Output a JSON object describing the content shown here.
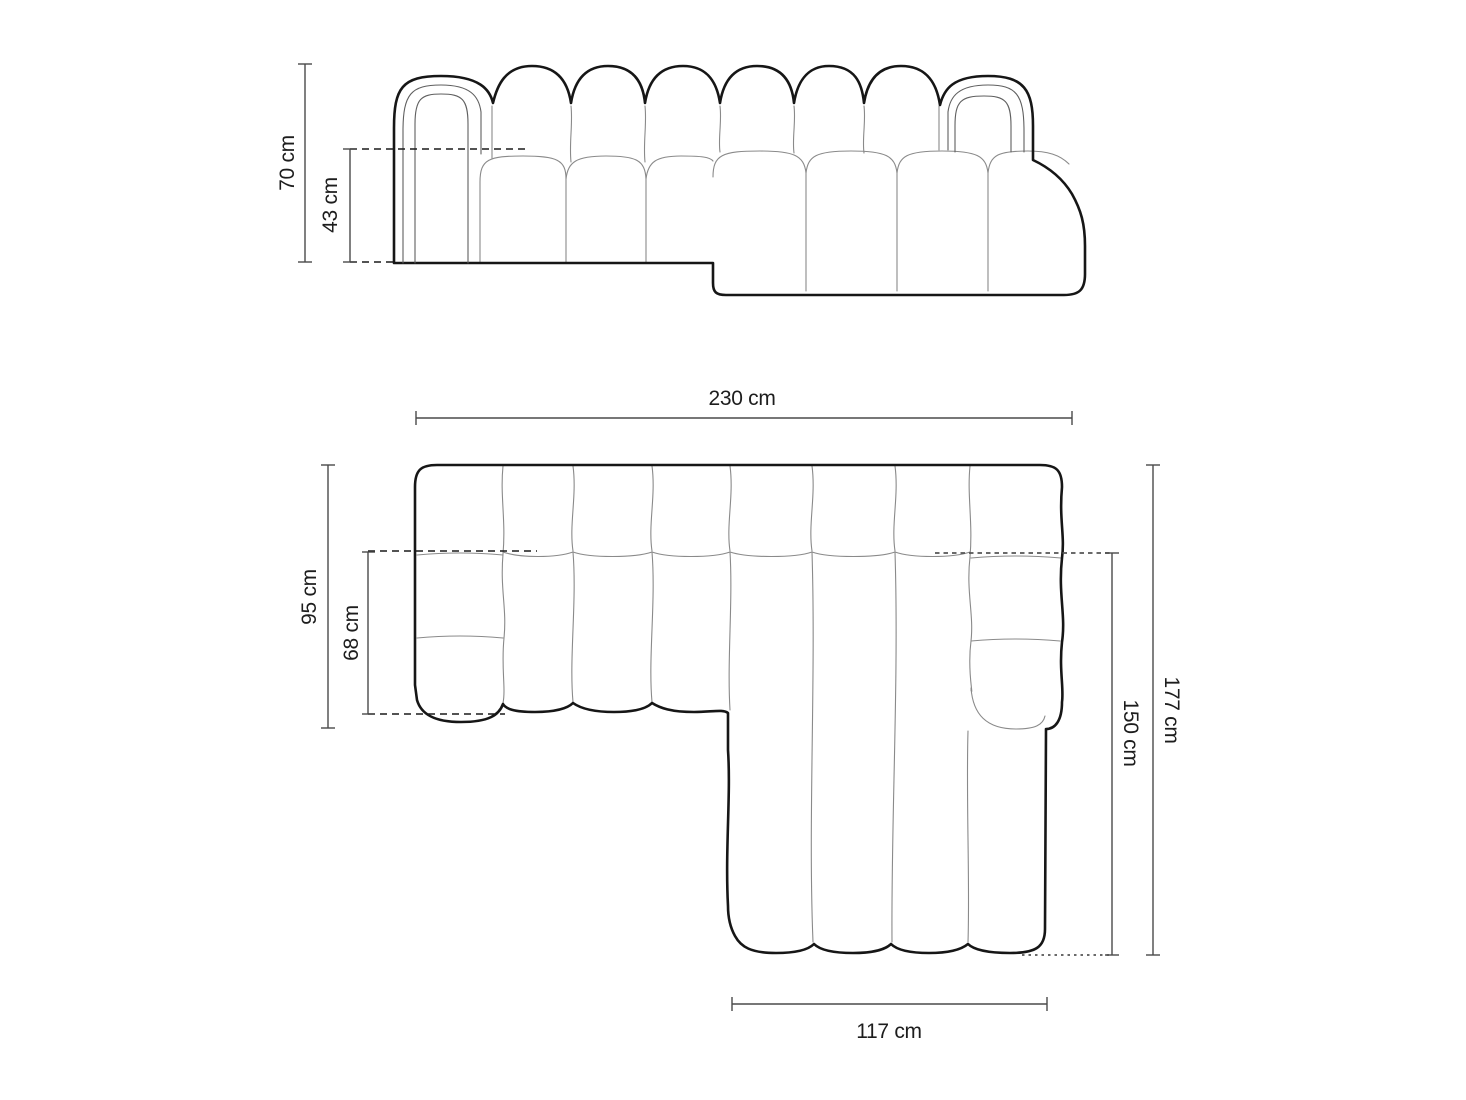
{
  "diagram": {
    "type": "furniture-dimension-diagram",
    "subject": "modular chaise sofa",
    "colors": {
      "background": "#ffffff",
      "outline_bold": "#161616",
      "outline_thin": "#8a8a8a",
      "outline_medium": "#5f5f5f",
      "dimension_line": "#4a4a4a",
      "label_text": "#1d1d1d"
    },
    "views": {
      "front_elevation": {
        "name": "front elevation"
      },
      "top_plan": {
        "name": "top plan view"
      }
    },
    "dimensions": {
      "front_total_height": "70 cm",
      "front_seat_height": "43 cm",
      "plan_total_width": "230 cm",
      "plan_body_depth": "95 cm",
      "plan_seat_depth": "68 cm",
      "plan_total_depth": "177 cm",
      "plan_chaise_depth": "150 cm",
      "plan_chaise_width": "117 cm"
    }
  }
}
